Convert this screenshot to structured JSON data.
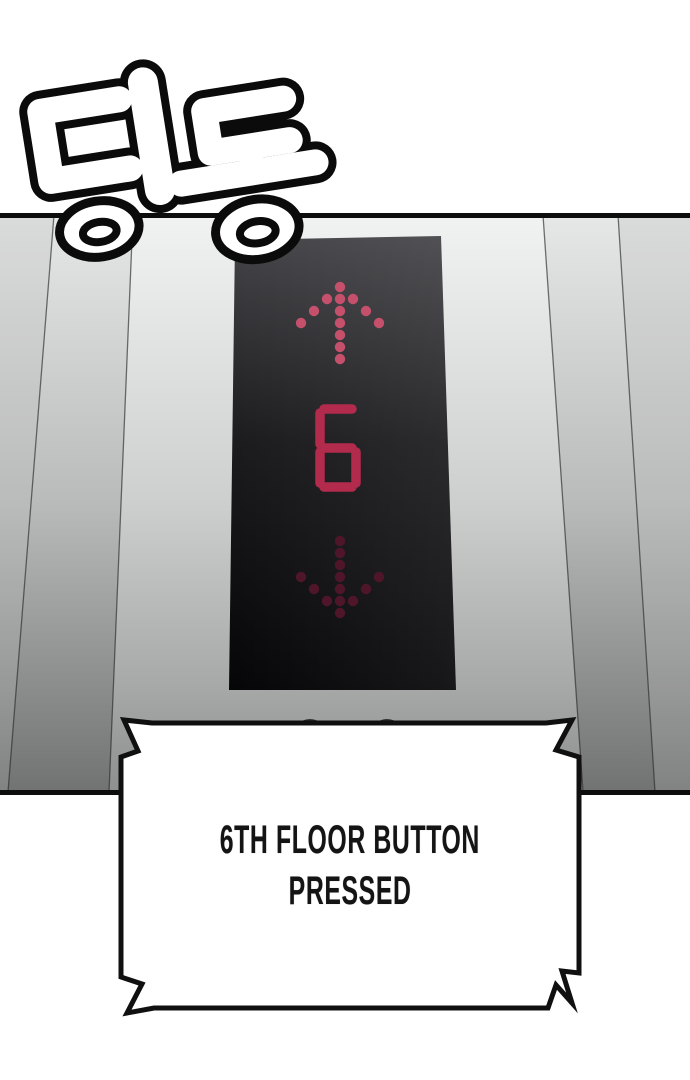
{
  "sfx": {
    "text": "딩동"
  },
  "elevator_display": {
    "floor": "6",
    "up_indicator": "lit",
    "down_indicator": "unlit"
  },
  "caption": {
    "lines": [
      "6TH FLOOR BUTTON",
      "PRESSED"
    ]
  },
  "colors": {
    "arrow-lit": "#c4506b",
    "arrow-unlit": "#4e1628",
    "digit": "#b22b4d",
    "panel-top": "#454549",
    "panel-mid": "#1c1c1f",
    "panel-bottom": "#060608",
    "wall-top": "#f1f2f2",
    "wall-mid": "#cdcfcf",
    "wall-bottom": "#8e9090",
    "pillar-top": "#e6e8e8",
    "pillar-mid": "#b9bbbb",
    "pillar-bottom": "#717373",
    "trim-line": "#0d0d0d",
    "indicator-dot": "#2e2e30",
    "caption-bg": "#ffffff",
    "caption-border": "#101010",
    "caption-text": "#141414",
    "sfx-fill": "#ffffff",
    "sfx-outline": "#0b0b0b"
  }
}
